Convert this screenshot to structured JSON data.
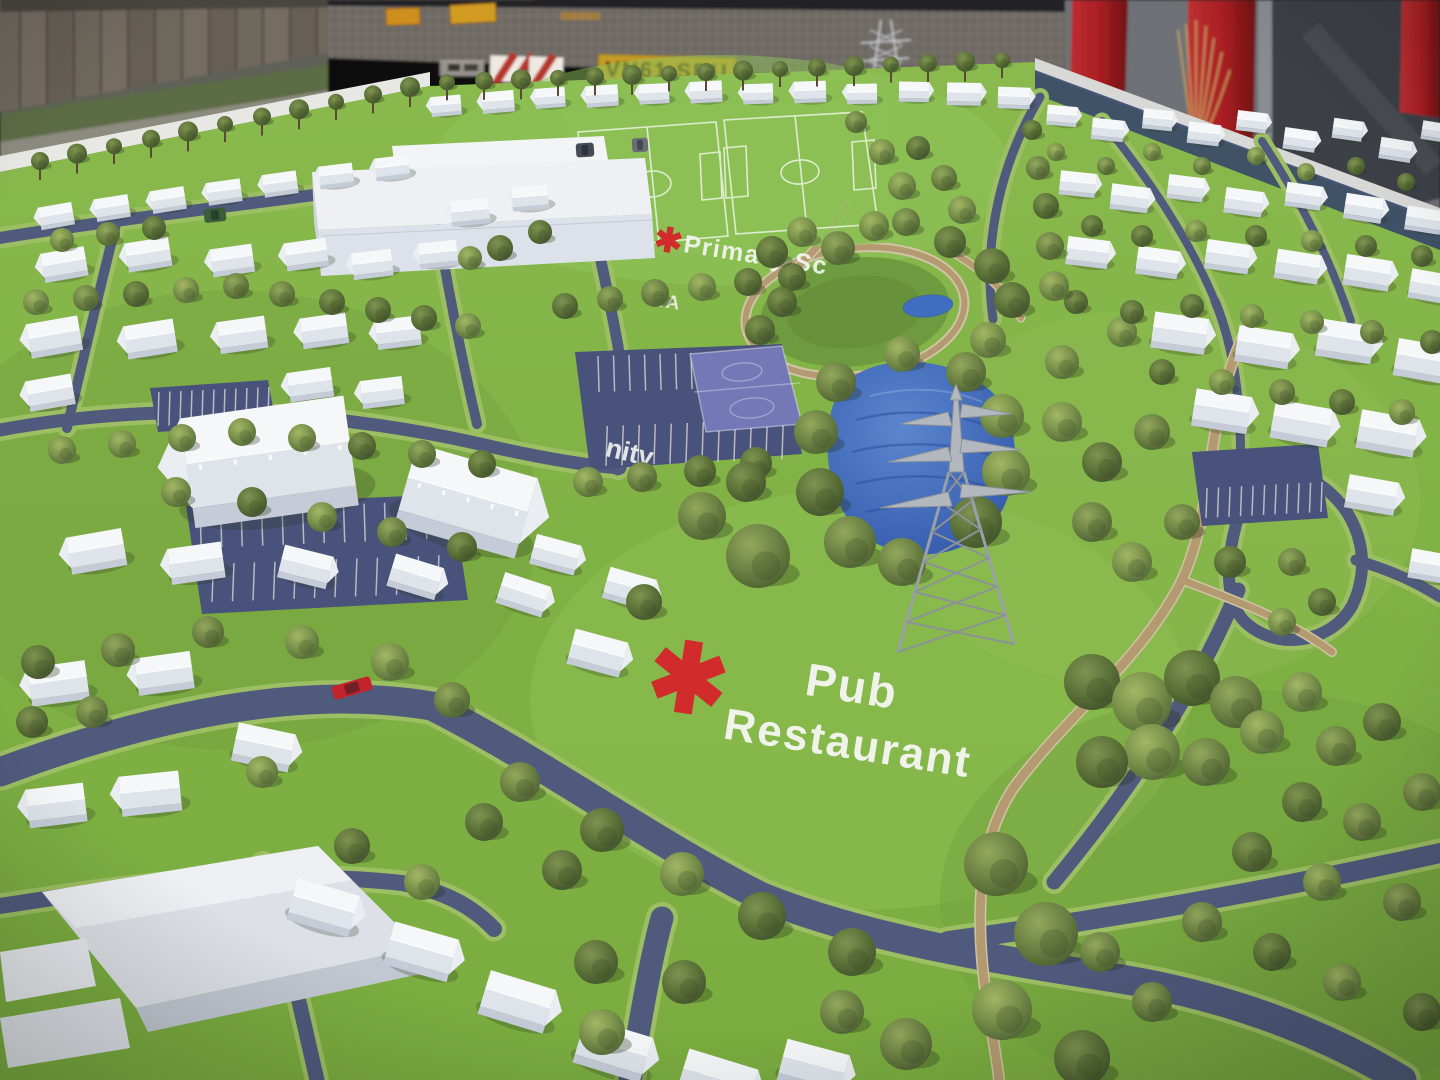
{
  "scene": {
    "description": "Photograph of an architectural scale model of a planned residential development, viewed at an oblique angle. White card houses and larger buildings sit on a printed green base with blue-grey roads, parking courts, sports pitches, a blue pond and many model trees. A lattice electricity pylon model stands on the green. Behind the model table are a lorry trailer, a wooden fence and red steel pillars.",
    "model_labels": {
      "pub_line1": "Pub",
      "pub_line2": "Restaurant",
      "primary_school_partial": "Primary Sc",
      "community_partial": "nity",
      "sports_area_partial": "TA",
      "marker_glyph": "✱"
    },
    "background": {
      "license_plate": "VN61 SBU"
    }
  },
  "colors": {
    "grass": "#7fb144",
    "grass_light": "#8dc156",
    "road": "#4f5a7d",
    "road_verge": "#9dbf63",
    "parking": "#49527a",
    "court_blue": "#7478b6",
    "water": "#3f6dc0",
    "water_dark": "#2c50a0",
    "path_tan": "#b49a70",
    "path_edge": "#cfc4a4",
    "tree_green": "#5f7440",
    "house_white": "#f5f7f9",
    "roof_shade": "#dfe4eb",
    "marker_red": "#d22b2b",
    "label_white": "#f4f6f0",
    "plate_yellow": "#c59b28",
    "plate_text": "#2b2316",
    "pillar_red": "#a81e22",
    "fence_brown": "#6e675d",
    "trailer_dark": "#1c1c1f",
    "pylon_grey": "#b3b8be"
  }
}
